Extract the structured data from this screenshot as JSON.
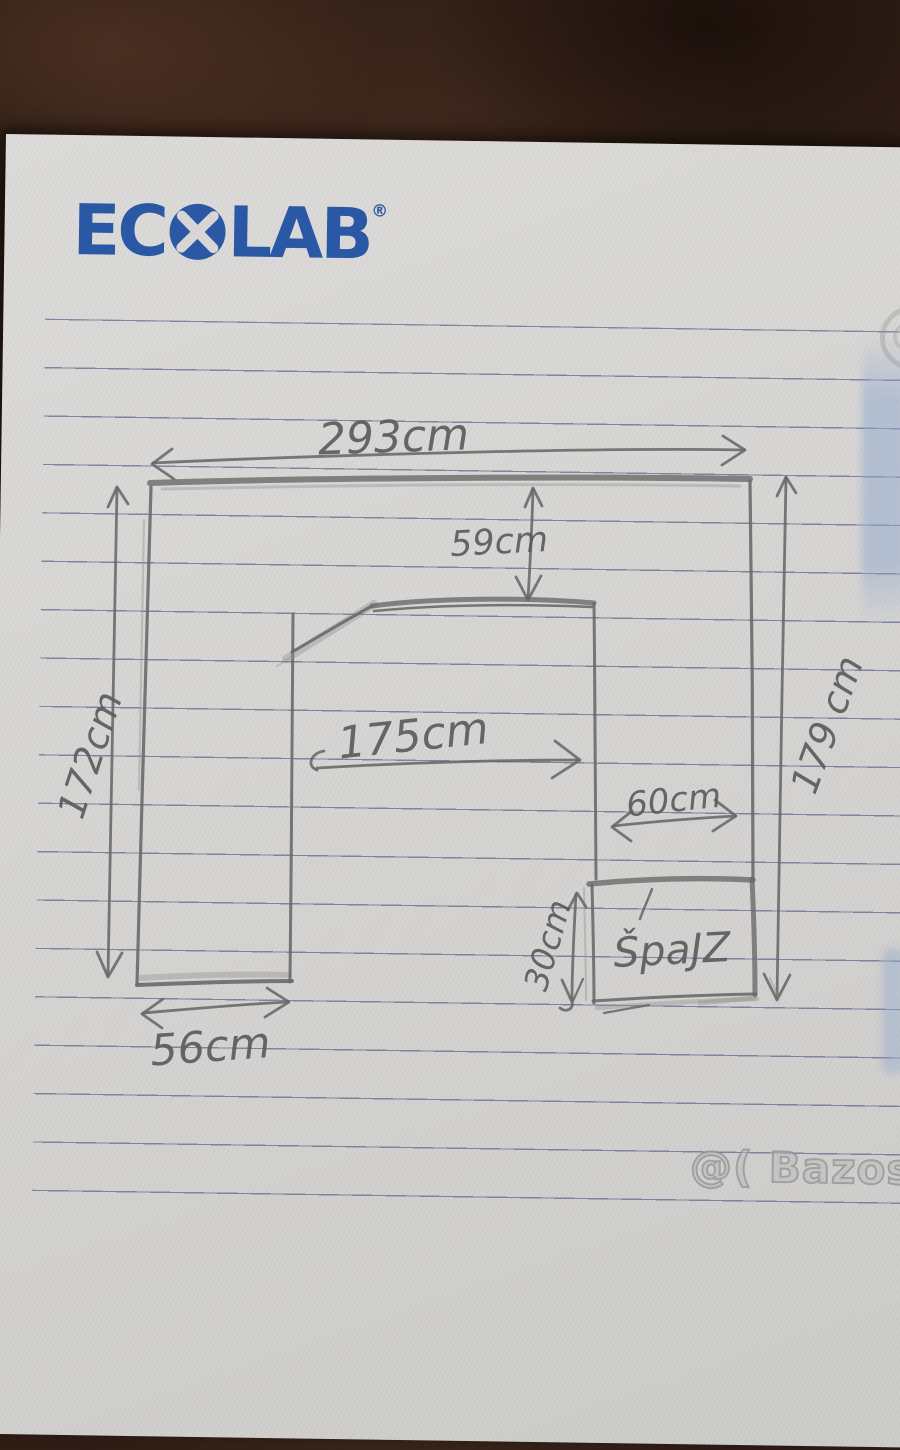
{
  "brand": {
    "name": "ECOLAB",
    "registered": "®"
  },
  "sketch_labels": {
    "top_width": "293cm",
    "top_inset_depth": "59cm",
    "inner_width": "175cm",
    "pantry_width": "60cm",
    "pantry_depth": "30cm",
    "left_height": "172cm",
    "right_height": "179 cm",
    "bottom_left_width": "56cm",
    "pantry_name": "ŠpaJZ"
  },
  "watermark": {
    "text": "@( Bazos.cz"
  },
  "colors": {
    "brand_blue": "#2b58a5",
    "pencil_gray": "#686868",
    "paper": "#d6d5d3",
    "desk_brown": "#2e1d15",
    "ruled_line": "#646e94",
    "blue_reflection": "#8ea6ce"
  }
}
